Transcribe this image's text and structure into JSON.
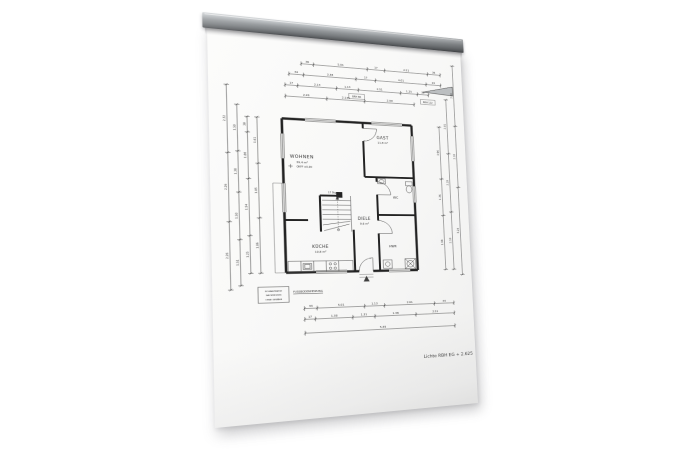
{
  "photo": {
    "background": "#ffffff",
    "paper_color": "#f7f7f5"
  },
  "rail": {
    "metal_light": "#c6c9cc",
    "metal_dark": "#54575a"
  },
  "plan": {
    "rooms": {
      "wohnen": {
        "label": "WOHNEN",
        "area": "39,4 m²",
        "level": "OKFF ±0,00"
      },
      "gast": {
        "label": "GAST",
        "area": "11,8 m²"
      },
      "diele": {
        "label": "DIELE",
        "area": "9,6 m²"
      },
      "kueche": {
        "label": "KÜCHE",
        "area": "10,8 m²"
      },
      "wc": {
        "label": "WC"
      },
      "hwr": {
        "label": "HWR"
      }
    },
    "stairs_note": "17 Stg",
    "lintel_boxes": [
      "BRH 86",
      "BRH 112"
    ],
    "notes": {
      "underline_note": "FUSSBODENHEIZUNG",
      "stamp": [
        "ROHBAUMASSE",
        "NACHMESSEN",
        "OHNE GEWÄHR"
      ],
      "height_note": "Lichte RBH EG + 2.625"
    },
    "dims": {
      "top1": [
        "36",
        "5.01",
        "17",
        "2.51",
        "36"
      ],
      "top2": [
        "34",
        "3.38",
        "17",
        "4.01",
        "24"
      ],
      "top3": [
        "17",
        "2.13",
        "1.13",
        "2.51",
        "1.25",
        "36"
      ],
      "top4": [
        "2.26",
        "2.135",
        "2.99"
      ],
      "bottom1": [
        "34",
        "5.01",
        "1.13",
        "2.61",
        "34"
      ],
      "bottom2": [
        "17",
        "1.38",
        "1.31",
        "1.38",
        "2.51"
      ],
      "bottom3": [
        "5.49"
      ],
      "left1": [
        "2.32",
        "2.26",
        "2.26"
      ],
      "left2": [
        "1.50",
        "1.38",
        "1.50",
        "1.51"
      ],
      "left3": [
        "38",
        "1.88",
        "1.94",
        "1.25"
      ],
      "left4": [
        "1.61",
        "1.85",
        "1.86"
      ],
      "right1": [
        "2.30",
        "2.32",
        "3.24"
      ],
      "right2": [
        "2.01",
        "2.19",
        "2.10"
      ],
      "right3": [
        "1.96",
        "1.36",
        "1.98"
      ]
    }
  }
}
